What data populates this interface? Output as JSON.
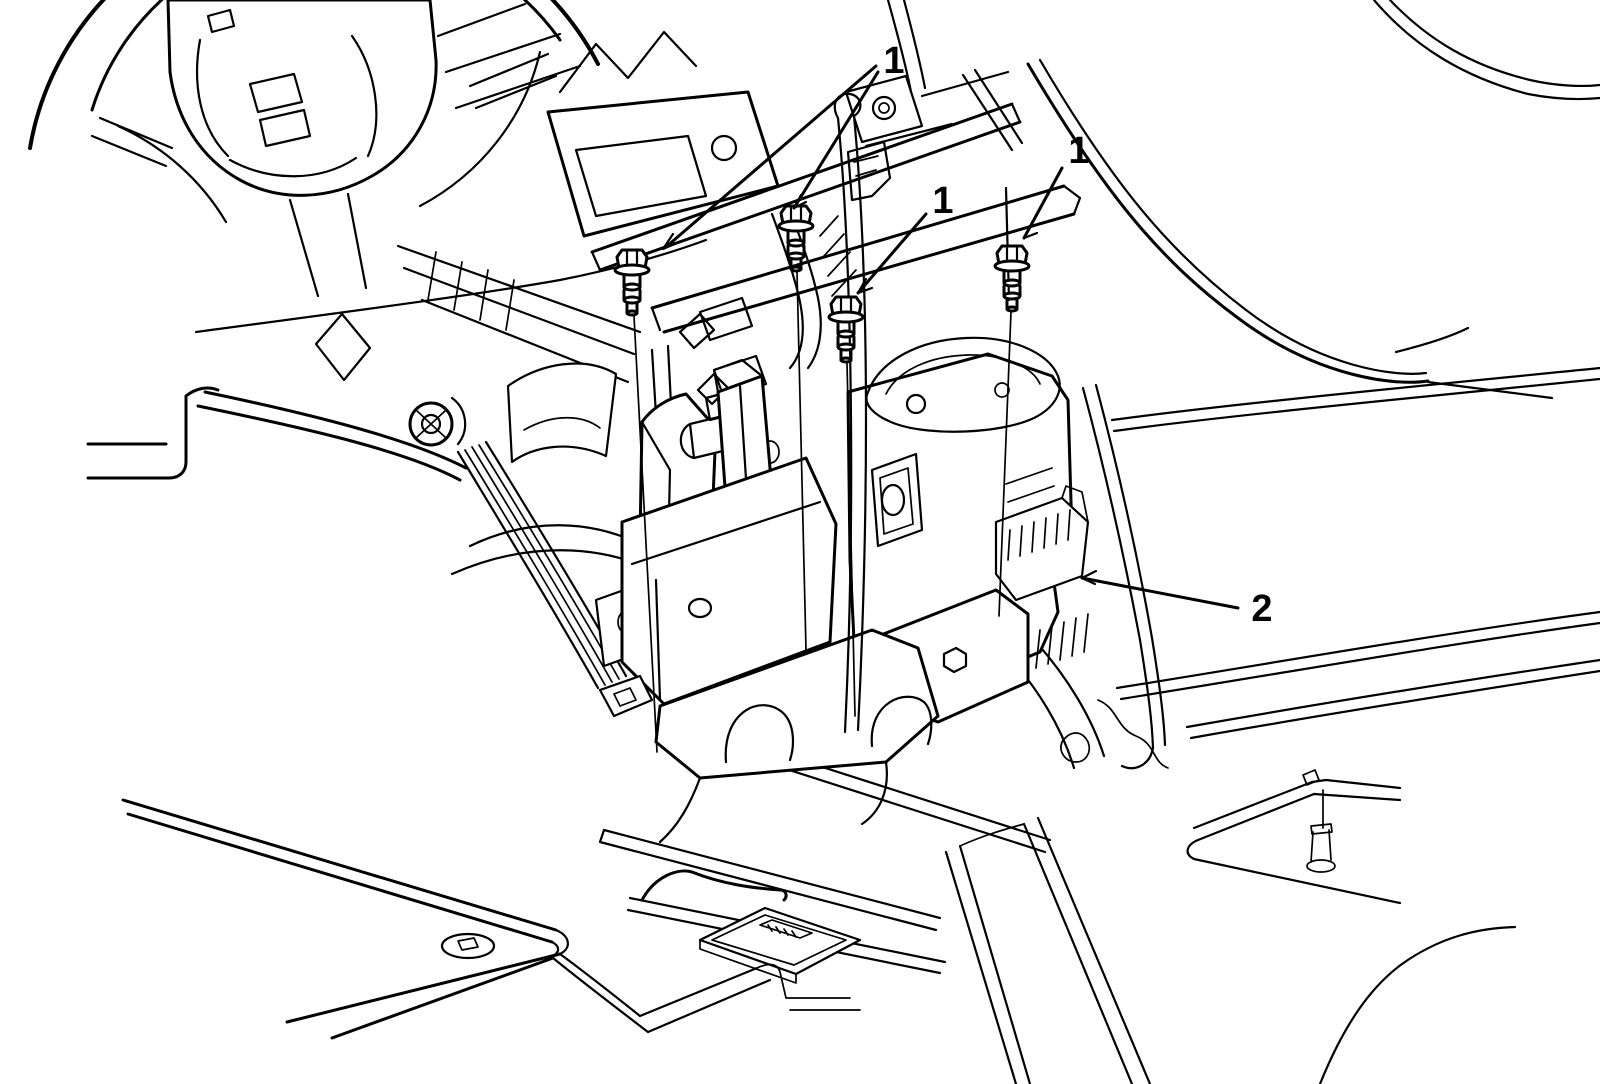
{
  "figure": {
    "kind": "service-manual-line-illustration",
    "colors": {
      "background": "#ffffff",
      "line": "#000000"
    },
    "callouts": [
      {
        "id": "callout-1-top",
        "label": "1",
        "x": 894,
        "y": 73
      },
      {
        "id": "callout-1-mid",
        "label": "1",
        "x": 943,
        "y": 213
      },
      {
        "id": "callout-1-right",
        "label": "1",
        "x": 1079,
        "y": 163
      },
      {
        "id": "callout-2",
        "label": "2",
        "x": 1262,
        "y": 621
      }
    ]
  }
}
